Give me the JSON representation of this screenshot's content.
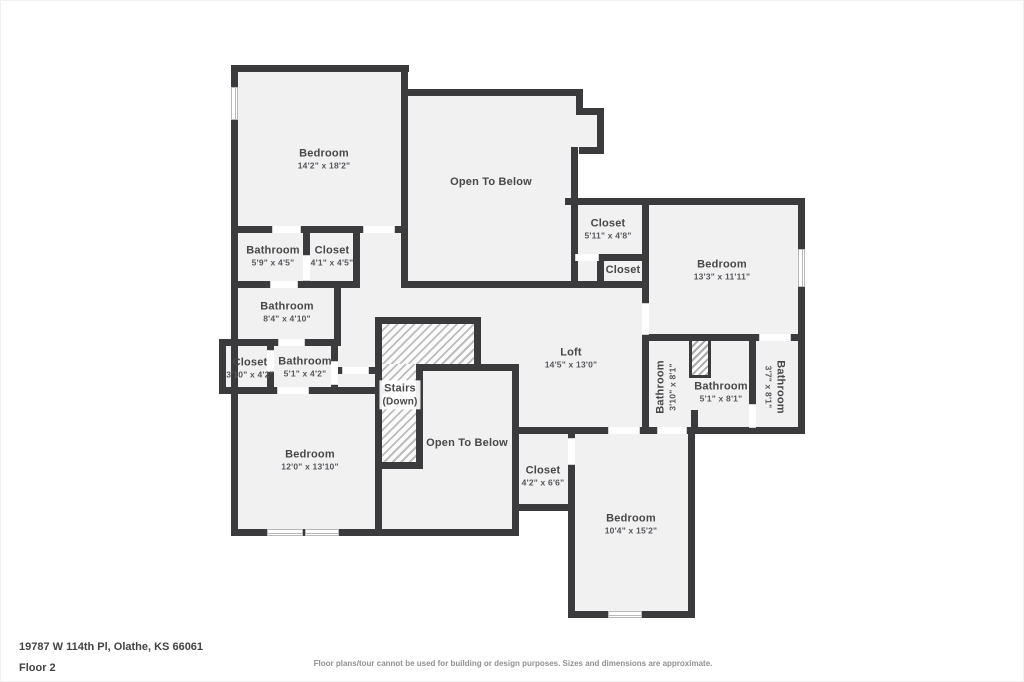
{
  "palette": {
    "wall": "#3b3b3d",
    "floor": "#f1f1f2",
    "background": "#ffffff",
    "label_text": "#48484a",
    "dim_text": "#55565a",
    "disclaimer_text": "#909090"
  },
  "rooms": [
    {
      "name": "Bedroom",
      "dims": "14'2\" x 18'2\""
    },
    {
      "name": "Open To Below",
      "dims": null
    },
    {
      "name": "Bathroom",
      "dims": "5'9\" x 4'5\""
    },
    {
      "name": "Closet",
      "dims": "4'1\" x 4'5\""
    },
    {
      "name": "Closet",
      "dims": "5'11\" x 4'8\""
    },
    {
      "name": "Closet",
      "dims": null
    },
    {
      "name": "Bedroom",
      "dims": "13'3\" x 11'11\""
    },
    {
      "name": "Bathroom",
      "dims": "8'4\" x 4'10\""
    },
    {
      "name": "Closet",
      "dims": "3'10\" x 4'2\""
    },
    {
      "name": "Bathroom",
      "dims": "5'1\" x 4'2\""
    },
    {
      "name": "Stairs",
      "dims": "(Down)"
    },
    {
      "name": "Loft",
      "dims": "14'5\" x 13'0\""
    },
    {
      "name": "Bathroom",
      "dims": "3'10\" x 8'1\""
    },
    {
      "name": "Bathroom",
      "dims": "5'1\" x 8'1\""
    },
    {
      "name": "Bathroom",
      "dims": "3'7\" x 8'1\""
    },
    {
      "name": "Open To Below",
      "dims": null
    },
    {
      "name": "Bedroom",
      "dims": "12'0\" x 13'10\""
    },
    {
      "name": "Closet",
      "dims": "4'2\" x 6'6\""
    },
    {
      "name": "Bedroom",
      "dims": "10'4\" x 15'2\""
    }
  ],
  "footer": {
    "address": "19787 W 114th Pl, Olathe, KS 66061",
    "floor_label": "Floor 2",
    "disclaimer": "Floor plans/tour cannot be used for building or design purposes. Sizes and dimensions are approximate."
  }
}
